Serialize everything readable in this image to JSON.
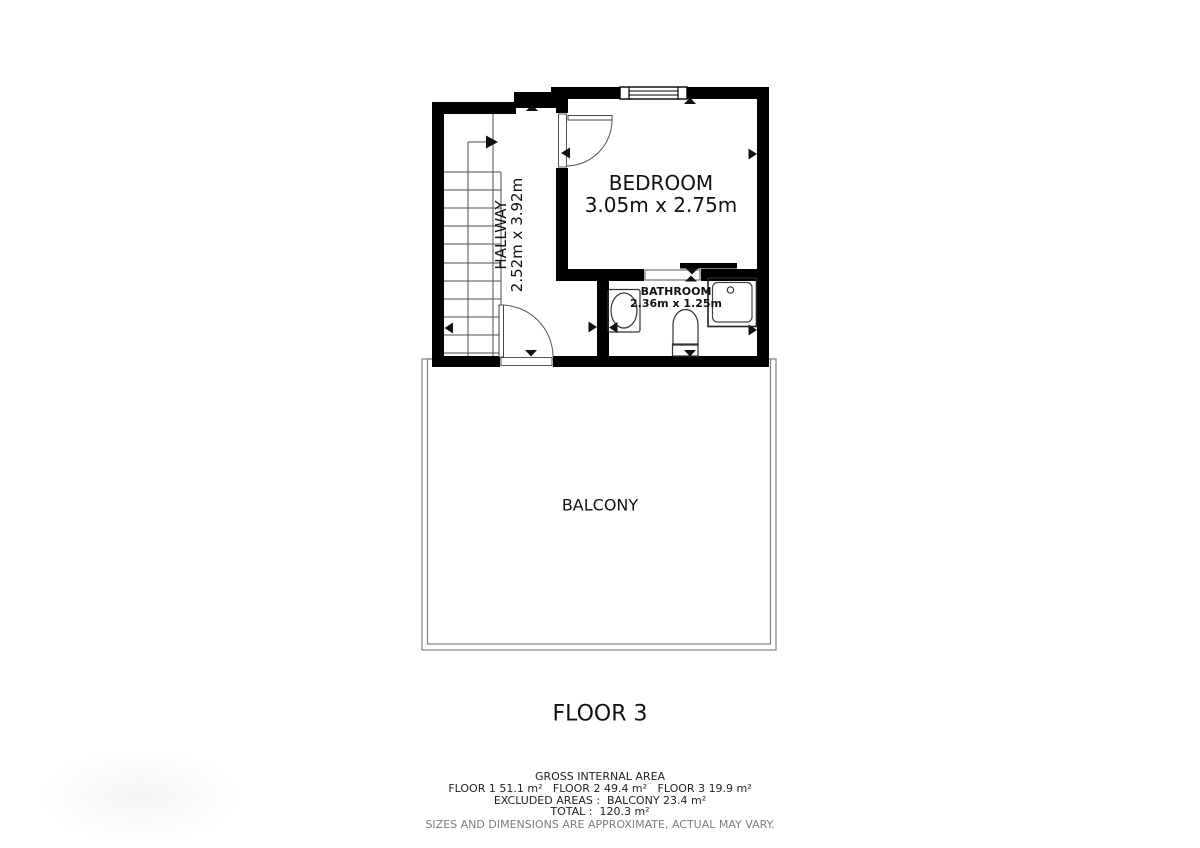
{
  "floor_plan": {
    "floor_label": "FLOOR 3",
    "rooms": {
      "hallway": {
        "name": "HALLWAY",
        "dimensions": "2.52m x 3.92m"
      },
      "bedroom": {
        "name": "BEDROOM",
        "dimensions": "3.05m x 2.75m"
      },
      "bathroom": {
        "name": "BATHROOM",
        "dimensions": "2.36m x 1.25m"
      },
      "balcony": {
        "name": "BALCONY"
      }
    },
    "icons": [
      "stairs-icon",
      "door-swing-icon",
      "sliding-door-icon",
      "window-icon",
      "washbasin-icon",
      "toilet-icon",
      "shower-tray-icon",
      "dimension-arrow-icon"
    ],
    "colors": {
      "wall": "#000000",
      "thin_line": "#555555",
      "balcony_line": "#808080",
      "text": "#111111",
      "muted_text": "#7d7d7d",
      "background": "#ffffff"
    }
  },
  "footer": {
    "title": "GROSS INTERNAL AREA",
    "floors_line": "FLOOR 1 51.1 m²   FLOOR 2 49.4 m²   FLOOR 3 19.9 m²",
    "excluded_line": "EXCLUDED AREAS :  BALCONY 23.4 m²",
    "total_line": "TOTAL :  120.3 m²",
    "disclaimer": "SIZES AND DIMENSIONS ARE APPROXIMATE, ACTUAL MAY VARY."
  }
}
